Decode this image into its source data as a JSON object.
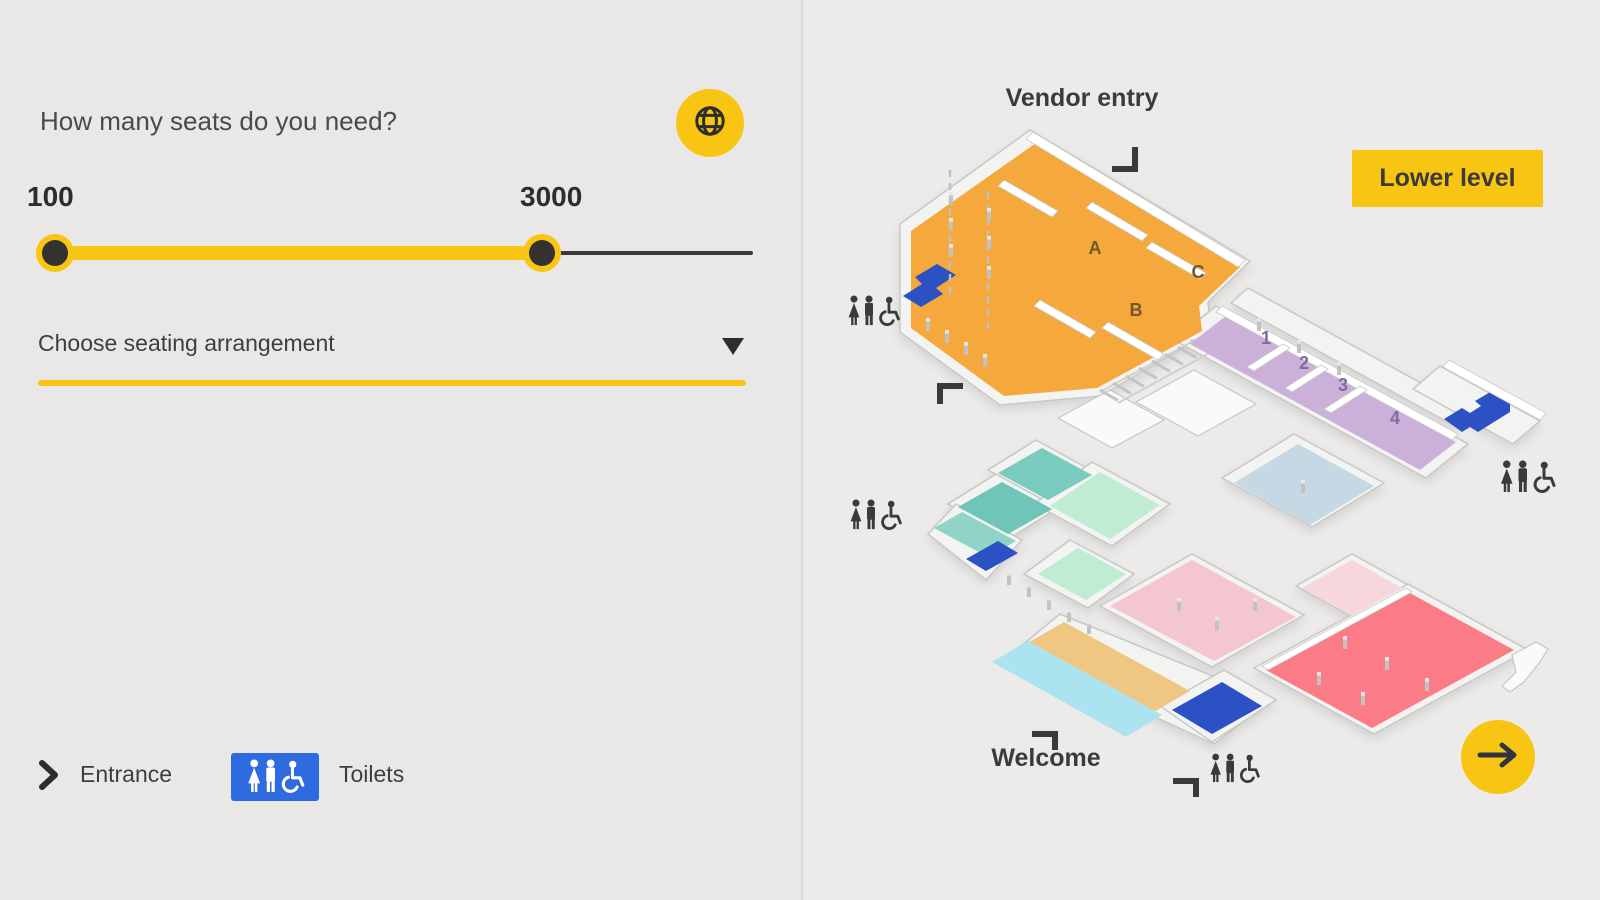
{
  "left_panel": {
    "heading": "How many seats do you need?",
    "slider": {
      "min_value": "100",
      "max_value": "3000"
    },
    "dropdown_label": "Choose seating arrangement",
    "legend": {
      "entrance": "Entrance",
      "toilets": "Toilets"
    }
  },
  "map": {
    "vendor_entry": "Vendor entry",
    "welcome": "Welcome",
    "lower_level_button": "Lower level",
    "hall_labels": {
      "a": "A",
      "b": "B",
      "c": "C"
    },
    "room_numbers": {
      "r1": "1",
      "r2": "2",
      "r3": "3",
      "r4": "4"
    }
  },
  "colors": {
    "accent_yellow": "#F9C513",
    "legend_blue": "#2F6BE0",
    "toilet_blue": "#2B51C4",
    "hall_orange": "#F5A83C",
    "rooms_purple": "#CBB1DA",
    "room_lightblue": "#C5D8E4",
    "room_teal_dark": "#79CBBE",
    "room_teal": "#6FC5B8",
    "corridor_teal": "#8FD4C7",
    "room_mint": "#C0ECD4",
    "room_pink": "#F3C6D1",
    "room_pink_light": "#F7D6DE",
    "hall_red": "#FB7B86",
    "corridor_tan": "#EFC783",
    "corridor_cyan": "#ABE4F0",
    "text_dark": "#3B3B3B"
  }
}
